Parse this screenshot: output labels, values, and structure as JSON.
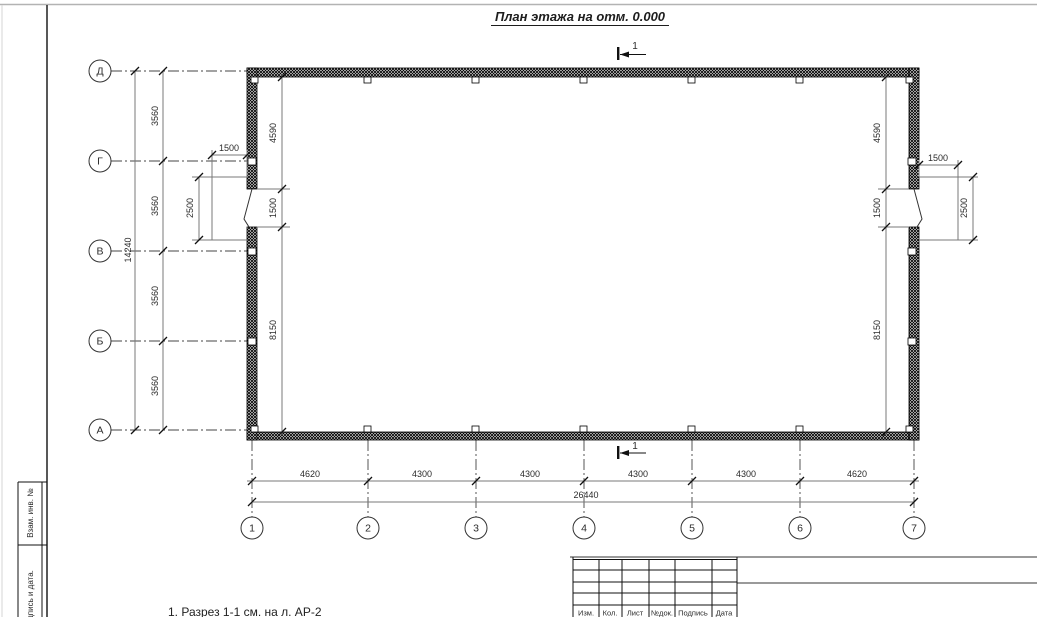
{
  "page": {
    "title": "План этажа на отм. 0.000",
    "note": "1. Разрез 1-1 см. на л. АР-2"
  },
  "axes": {
    "left": [
      "Д",
      "Г",
      "В",
      "Б",
      "А"
    ],
    "bottom": [
      "1",
      "2",
      "3",
      "4",
      "5",
      "6",
      "7"
    ]
  },
  "dims": {
    "left_total": "14240",
    "left_chain": [
      "3560",
      "3560",
      "3560",
      "3560"
    ],
    "bottom_total": "26440",
    "bottom_chain": [
      "4620",
      "4300",
      "4300",
      "4300",
      "4300",
      "4620"
    ],
    "side_chain": [
      "4590",
      "1500",
      "8150"
    ],
    "porch_depth": "1500",
    "porch_width": "2500"
  },
  "section_mark": "1",
  "margin": {
    "box1": "Взам. инв. №",
    "box2": "Подпись и дата."
  },
  "title_block": {
    "labels": [
      "Изм.",
      "Кол.",
      "Лист",
      "№док.",
      "Подпись",
      "Дата"
    ]
  },
  "colors": {
    "wall": "#000000",
    "dim_line": "#787878",
    "axis_line": "#444444",
    "frame": "#111111",
    "page_edge": "#b3b3b3"
  }
}
